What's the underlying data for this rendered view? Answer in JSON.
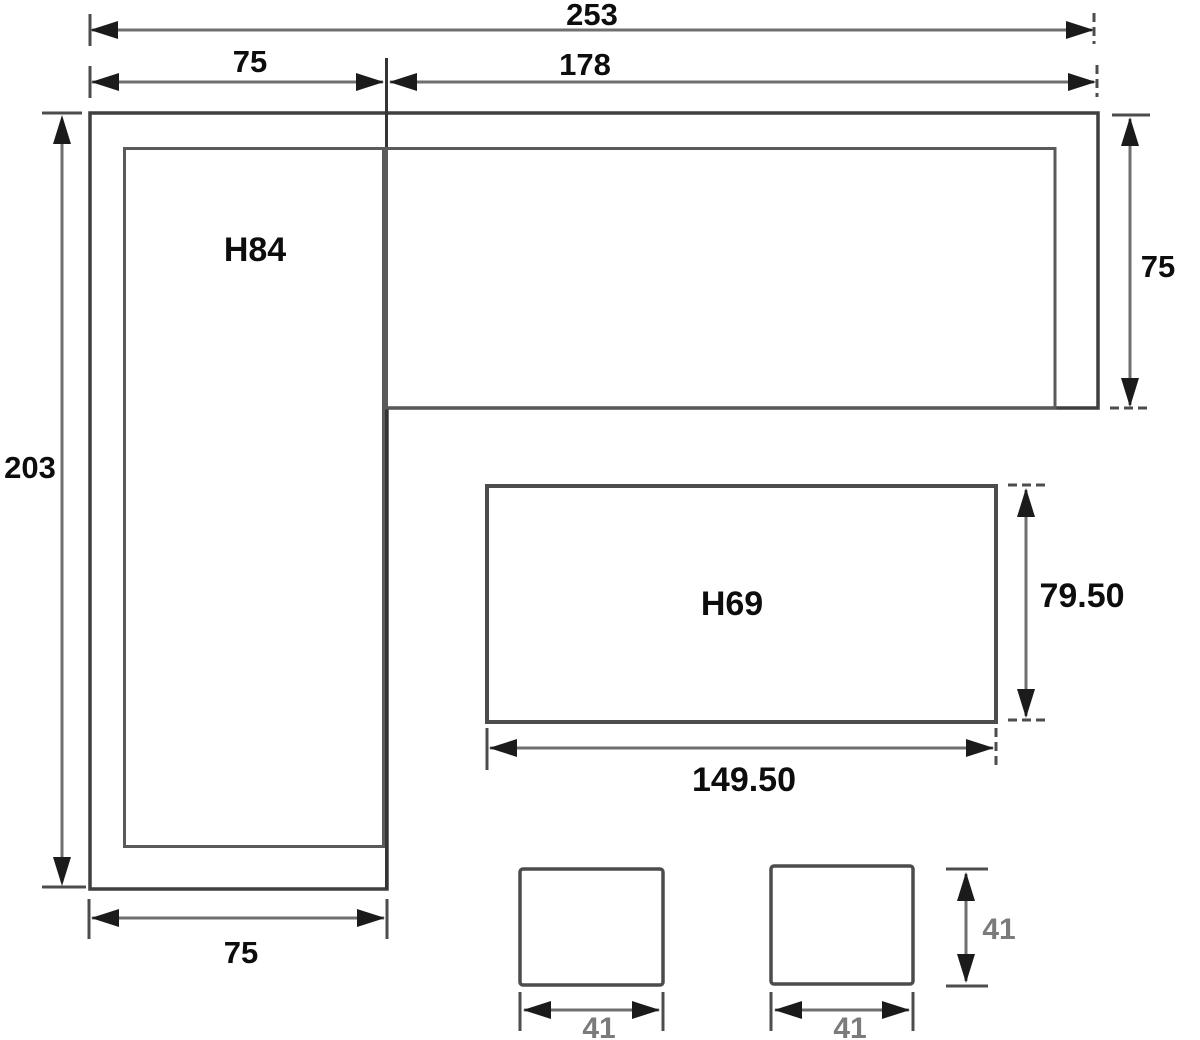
{
  "colors": {
    "background": "#ffffff",
    "shape_outline": "#3f3f3f",
    "dimension_line": "#6f6f6f",
    "arrowhead": "#1b1b1b",
    "label_text": "#0d0d0d",
    "muted_label_text": "#7b7b7b"
  },
  "sofa": {
    "label": "H84",
    "overall_width": "253",
    "left_section_width": "75",
    "chaise_section_width": "178",
    "overall_depth": "203",
    "chaise_depth": "75",
    "left_arm_width": "75"
  },
  "table": {
    "label": "H69",
    "depth": "79.50",
    "width": "149.50"
  },
  "stools": [
    {
      "width": "41"
    },
    {
      "width": "41"
    }
  ],
  "stool_depth": "41"
}
